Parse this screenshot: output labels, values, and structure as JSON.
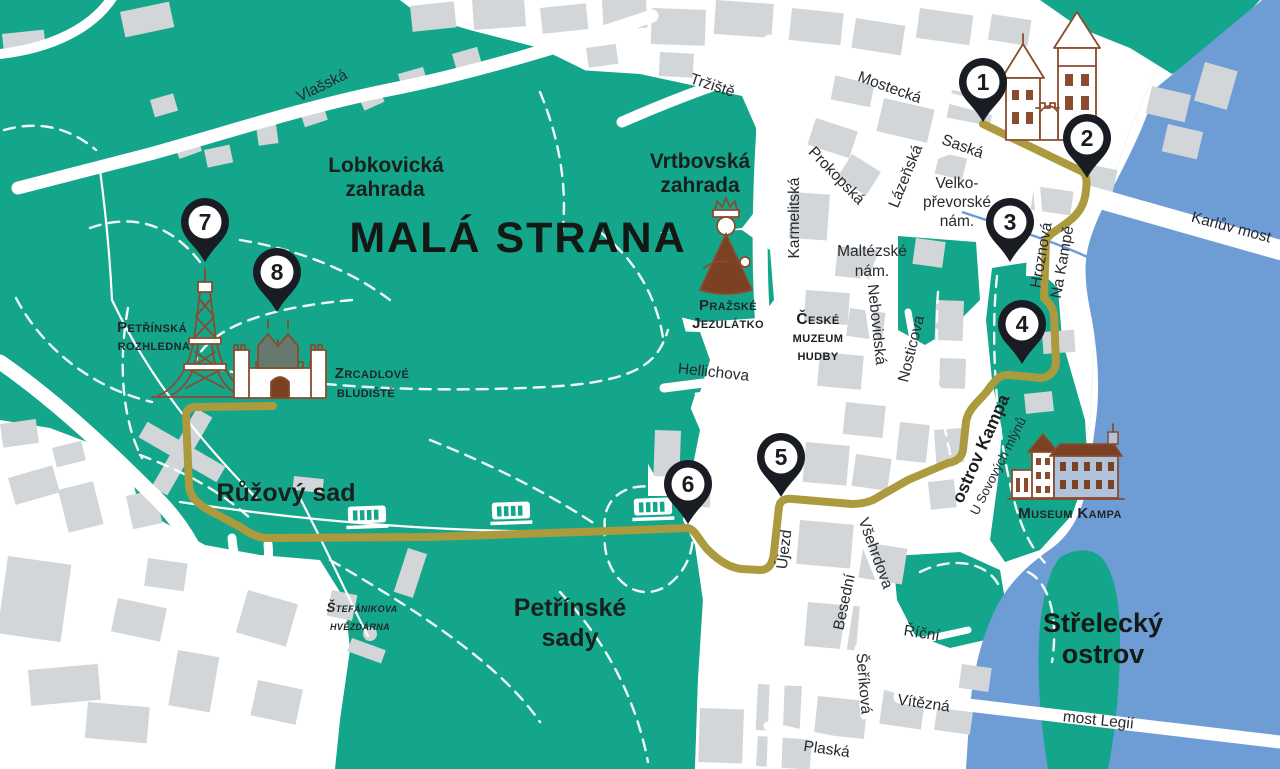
{
  "map": {
    "region_title": "MALÁ STRANA",
    "colors": {
      "park_green": "#14A68A",
      "water_blue": "#6E9DD6",
      "route_gold": "#AC9A3E",
      "building_gray": "#D3D6D8",
      "pin_black": "#191C22",
      "artwork_brown": "#8A4B2E"
    },
    "markers": [
      "1",
      "2",
      "3",
      "4",
      "5",
      "6",
      "7",
      "8"
    ],
    "parks": {
      "lobkovicka": [
        "Lobkovická",
        "zahrada"
      ],
      "vrtbovska": [
        "Vrtbovská",
        "zahrada"
      ],
      "ruzovy_sad": "Růžový sad",
      "petrinske_sady": [
        "Petřínské",
        "sady"
      ],
      "strelecky_ostrov": [
        "Střelecký",
        "ostrov"
      ]
    },
    "streets": {
      "vlasska": "Vlašská",
      "trziste": "Tržiště",
      "mostecka": "Mostecká",
      "saska": "Saská",
      "lazenska": "Lázeňská",
      "prokopska": "Prokopská",
      "karmelitska": "Karmelitská",
      "velkoprevorske": [
        "Velko-",
        "převorské",
        "nám."
      ],
      "maltezske": [
        "Maltézské",
        "nám."
      ],
      "nebovidska": "Nebovidská",
      "nosticova": "Nosticova",
      "hroznova": "Hroznová",
      "na_kampe": "Na Kampě",
      "karluv_most": "Karlův most",
      "hellichova": "Hellichova",
      "ujezd": "Újezd",
      "vsehrdova": "Všehrdova",
      "besedni": "Besední",
      "ricni": "Říční",
      "serikova": "Šeříková",
      "vitezna": "Vítězná",
      "most_legii": "most Legií",
      "plaska": "Plaská",
      "u_sovovych": "U Sovových mlýnů",
      "ostrov_kampa": "ostrov Kampa"
    },
    "landmarks": {
      "petrinska_rozhledna": [
        "Petřínská",
        "rozhledna"
      ],
      "zrcadlove_bludiste": [
        "Zrcadlové",
        "bludiště"
      ],
      "prazske_jezulatko": [
        "Pražské",
        "Jezulátko"
      ],
      "ceske_muzeum_hudby": [
        "České",
        "muzeum",
        "hudby"
      ],
      "museum_kampa": "Museum Kampa",
      "stefanikova_hvezdarna": [
        "Štefánikova",
        "hvězdárna"
      ]
    }
  }
}
